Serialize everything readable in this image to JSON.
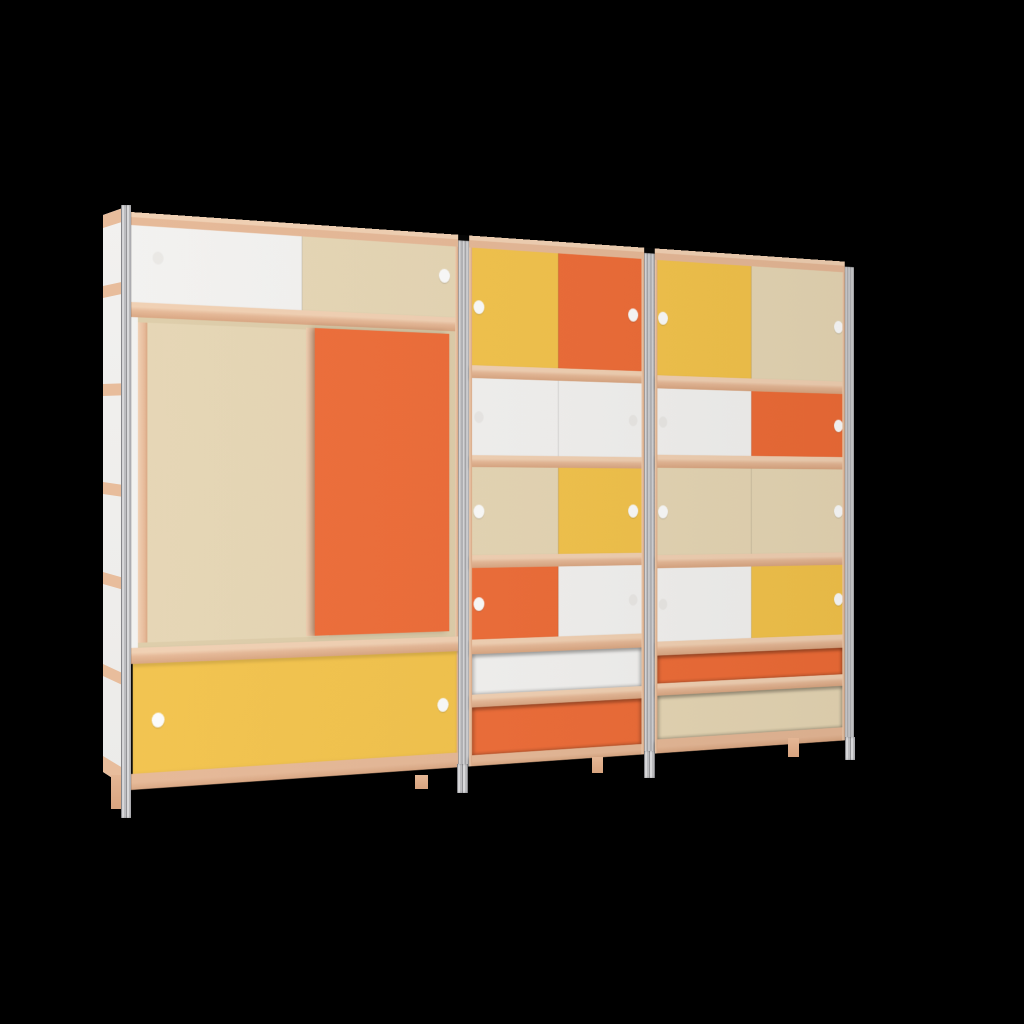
{
  "scene": {
    "type": "3d-furniture-render",
    "subject": "Modular wall storage cabinet, three bays with sliding doors and drawers, Mondrian-style color blocking, metal corner posts and plywood shelf edges",
    "background": "#000000"
  },
  "palette": {
    "background": "#000000",
    "orange": "#ed6b36",
    "yellow": "#f2c24a",
    "cream": "#e5d5b3",
    "cream_deep": "#ddcca8",
    "white": "#f2f1ef",
    "wood": "#e5b795",
    "wood_light": "#f0cfb1",
    "wood_dark": "#d8a47f",
    "wood_side": "#e8bd9c",
    "metal": "#bcbcbf",
    "metal_light": "#d8d8da",
    "metal_dark": "#939396",
    "knob": "#fbfbfa",
    "knob_faint": "#e9e7e4"
  },
  "units": [
    {
      "id": "left",
      "rows": [
        {
          "kind": "doors",
          "panels": [
            "white",
            "cream"
          ],
          "knobs": [
            "faint",
            "white"
          ]
        },
        {
          "kind": "sliding-doors",
          "panels": [
            "cream",
            "orange"
          ],
          "knobs": []
        },
        {
          "kind": "drawer-front",
          "panels": [
            "yellow"
          ],
          "knobs": [
            "white",
            "white"
          ]
        }
      ]
    },
    {
      "id": "middle",
      "rows": [
        {
          "kind": "doors",
          "panels": [
            "yellow",
            "orange"
          ],
          "knobs": [
            "white",
            "white"
          ]
        },
        {
          "kind": "doors",
          "panels": [
            "white",
            "white"
          ],
          "knobs": [
            "faint",
            "faint"
          ]
        },
        {
          "kind": "doors",
          "panels": [
            "cream",
            "yellow"
          ],
          "knobs": [
            "white",
            "white"
          ]
        },
        {
          "kind": "doors",
          "panels": [
            "orange",
            "white"
          ],
          "knobs": [
            "white",
            "faint"
          ]
        },
        {
          "kind": "open-band",
          "panels": [
            "white"
          ],
          "knobs": []
        },
        {
          "kind": "open-band",
          "panels": [
            "orange"
          ],
          "knobs": []
        }
      ]
    },
    {
      "id": "right",
      "rows": [
        {
          "kind": "doors",
          "panels": [
            "yellow",
            "cream"
          ],
          "knobs": [
            "white",
            "white"
          ]
        },
        {
          "kind": "doors",
          "panels": [
            "white",
            "orange"
          ],
          "knobs": [
            "faint",
            "white"
          ]
        },
        {
          "kind": "doors",
          "panels": [
            "cream",
            "cream"
          ],
          "knobs": [
            "white",
            "white"
          ]
        },
        {
          "kind": "doors",
          "panels": [
            "white",
            "yellow"
          ],
          "knobs": [
            "faint",
            "white"
          ]
        },
        {
          "kind": "open-band",
          "panels": [
            "orange"
          ],
          "knobs": []
        },
        {
          "kind": "open-band",
          "panels": [
            "cream"
          ],
          "knobs": []
        }
      ]
    }
  ]
}
